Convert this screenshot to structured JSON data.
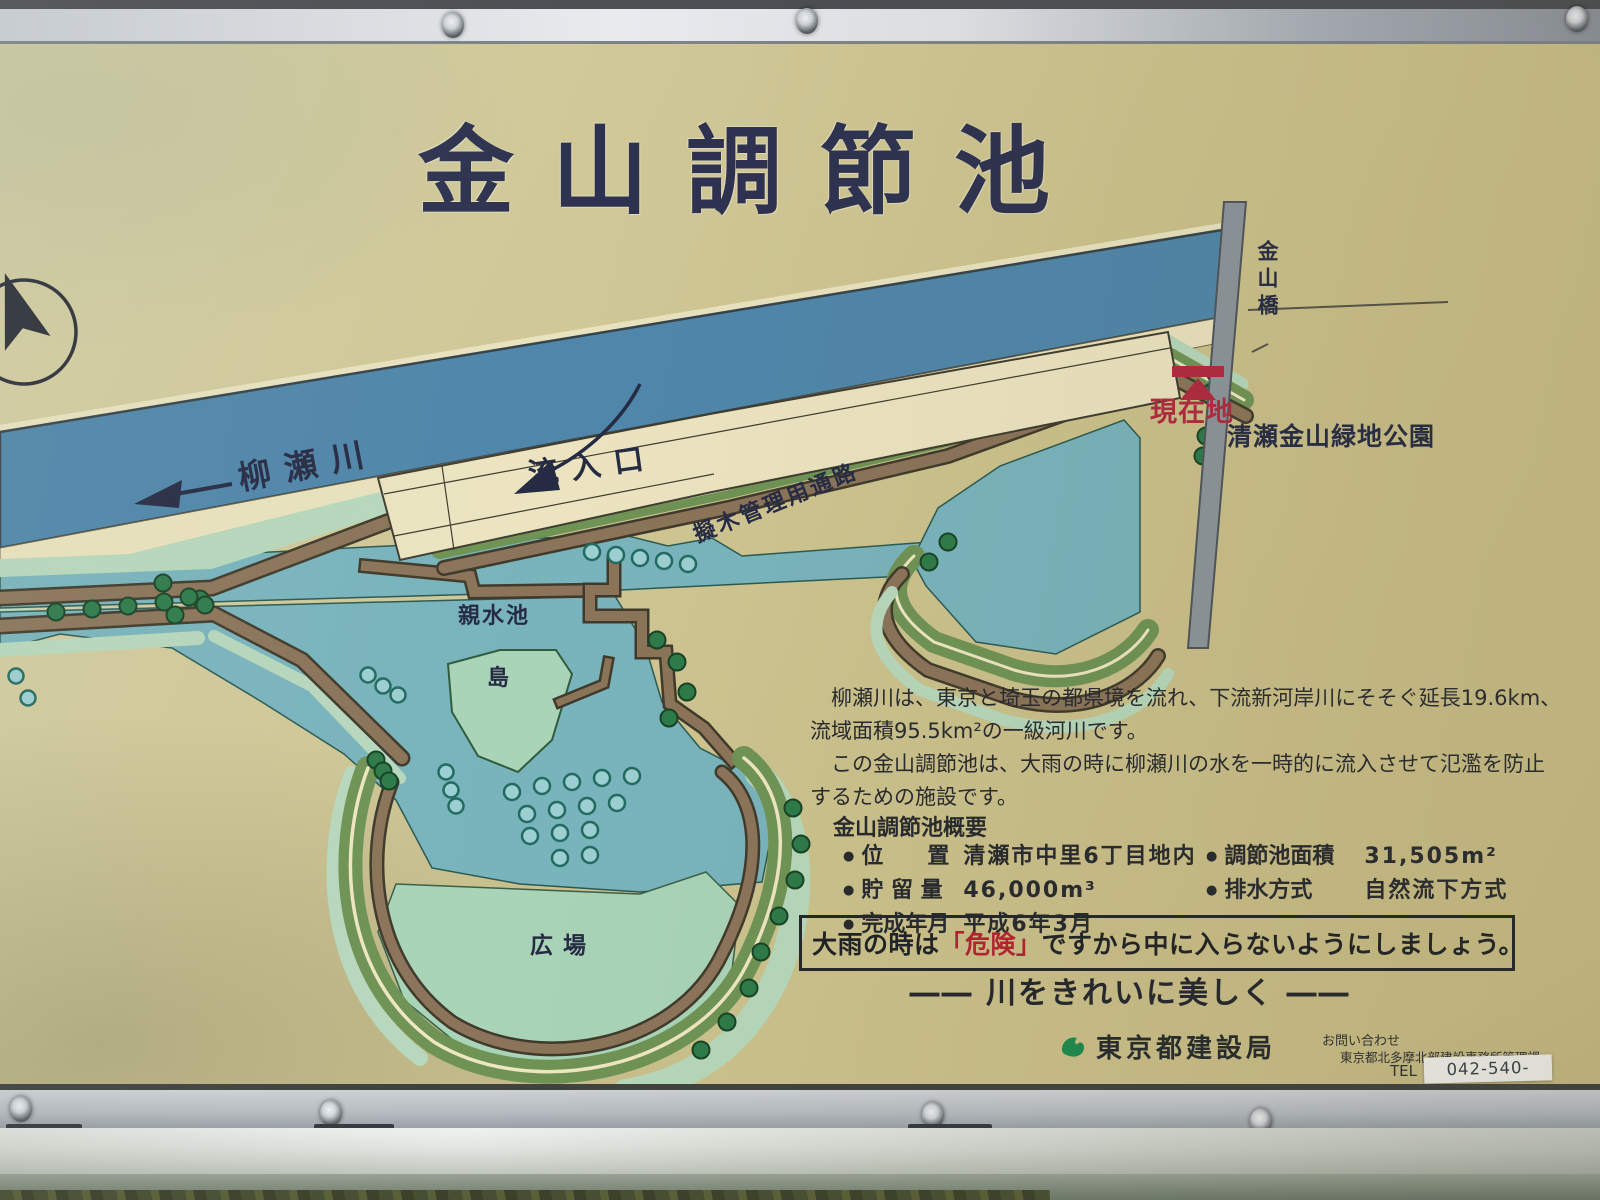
{
  "sign": {
    "title": "金山調節池",
    "map": {
      "labels": {
        "river": "柳瀬川",
        "inflow": "流入口",
        "path": "擬木管理用通路",
        "pond": "親水池",
        "island": "島",
        "plaza": "広場",
        "current": "現在地",
        "bridge": "金山橋",
        "park": "清瀬金山緑地公園"
      },
      "colors": {
        "river": "#4f86aa",
        "pond": "#79b4bd",
        "plaza": "#a9d4b8",
        "island": "#a9d4b8",
        "weir": "#ece4c0",
        "bridge": "#8c959c",
        "embankment": "#6f9355",
        "path_brown": "#8b7459",
        "tree": "#2d7a49",
        "marker_red": "#b02a3f"
      }
    },
    "description": {
      "lines": [
        "　柳瀬川は、東京と埼玉の都県境を流れ、下流新河岸川にそそぐ延長19.6km、",
        "流域面積95.5km²の一級河川です。",
        "　この金山調節池は、大雨の時に柳瀬川の水を一時的に流入させて氾濫を防止",
        "するための施設です。"
      ]
    },
    "overview": {
      "heading": "金山調節池概要",
      "bullet": "●",
      "col1": [
        {
          "label": "位　　置",
          "value": "清瀬市中里6丁目地内"
        },
        {
          "label": "貯 留 量",
          "value": "46,000m³"
        },
        {
          "label": "完成年月",
          "value": "平成6年3月"
        }
      ],
      "col2": [
        {
          "label": "調節池面積",
          "value": "31,505m²"
        },
        {
          "label": "排水方式",
          "value": "自然流下方式"
        }
      ]
    },
    "warning": {
      "pre": "大雨の時は",
      "danger": "「危険」",
      "post": "ですから中に入らないようにしましょう。"
    },
    "slogan": {
      "dash": "――",
      "text": "川をきれいに美しく"
    },
    "agency": "東京都建設局",
    "contact": {
      "heading": "お問い合わせ",
      "office": "東京都北多摩北部建設事務所管理課",
      "tel_label": "TEL",
      "tel_number": "042-540-9508"
    }
  }
}
